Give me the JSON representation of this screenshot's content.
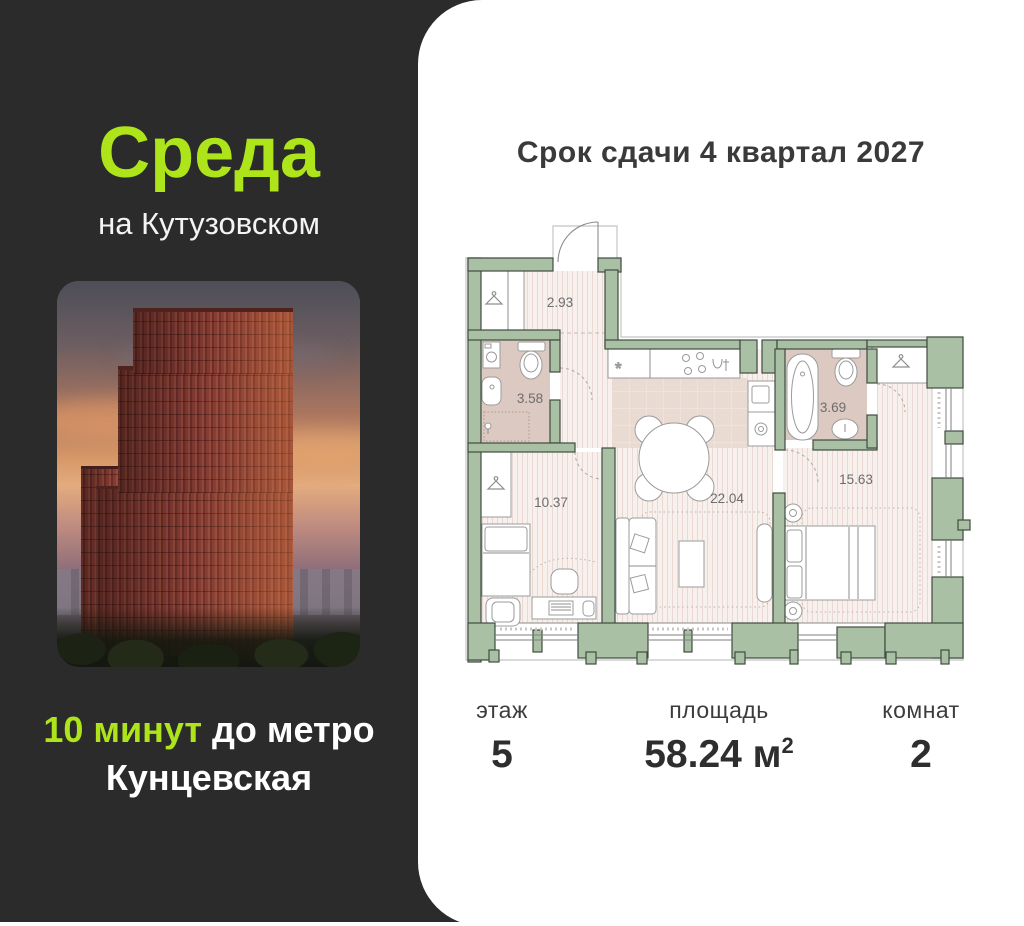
{
  "brand": {
    "name_line1": "Среда",
    "name_line2": "на Кутузовском",
    "metro_minutes": "10 минут",
    "metro_rest": " до метро",
    "metro_station": "Кунцевская"
  },
  "card": {
    "title": "Срок сдачи 4 квартал 2027"
  },
  "floorplan": {
    "areas": {
      "hallway": "2.93",
      "bathroom_small": "3.58",
      "bathroom_large": "3.69",
      "room_small": "10.37",
      "living": "22.04",
      "bedroom": "15.63"
    }
  },
  "stats": {
    "floor": {
      "label": "этаж",
      "value": "5"
    },
    "area": {
      "label": "площадь",
      "value": "58.24 м",
      "sup": "2"
    },
    "rooms": {
      "label": "комнат",
      "value": "2"
    }
  },
  "colors": {
    "accent_green": "#aee51a",
    "panel_dark": "#2b2b2c",
    "wall_sage": "#a9c0a5",
    "room_fill": "#f7f0ec",
    "wet_room_fill": "#dcc9c1"
  }
}
